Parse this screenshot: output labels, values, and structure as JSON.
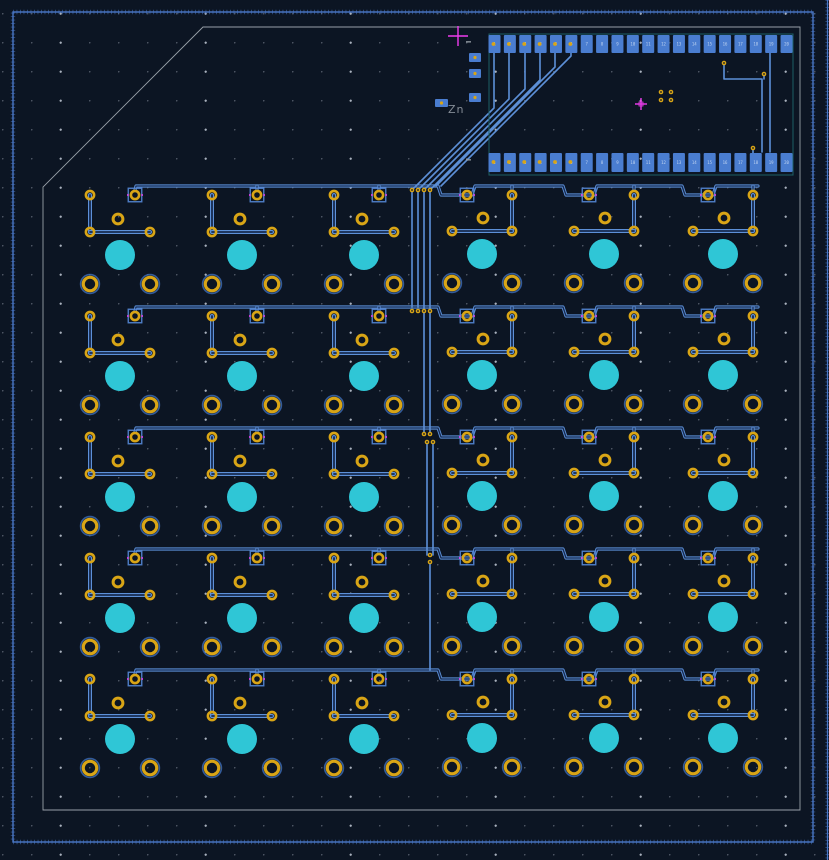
{
  "canvas": {
    "width": 829,
    "height": 860,
    "background": "#0c1523"
  },
  "colors": {
    "background": "#0c1523",
    "grid_dot": "#969eaf",
    "track": "#5d90d8",
    "track_inner": "#16294e",
    "pad_smd": "#4a7dd0",
    "pad_square_outline": "#5588d8",
    "pad_text": "#d8e6f8",
    "tht_ring_gold": "#d9a516",
    "hole_dark": "#0c1523",
    "npth_cyan": "#2fc6d6",
    "via_gold": "#d9a516",
    "courtyard_teal": "#1d6066",
    "board_edge_gray": "#98a0a8",
    "zone_outline_blue": "#4a78c8",
    "anchor_magenta": "#ee3cee",
    "ref_text_gray": "#858c96",
    "mount_halo_blue": "#3d6db8"
  },
  "zone": {
    "rect": [
      13,
      12,
      800,
      830
    ],
    "right_edge_x": 827.5
  },
  "board_edge": {
    "points": [
      [
        203,
        27
      ],
      [
        800,
        27
      ],
      [
        800,
        810
      ],
      [
        43,
        810
      ],
      [
        43,
        187
      ]
    ]
  },
  "origin_marker": {
    "x": 458,
    "y": 36,
    "arm": 10
  },
  "module": {
    "ref_label": "Zn",
    "ref_pos": [
      448,
      103
    ],
    "courtyard": [
      489,
      34,
      304,
      141
    ],
    "pad_count_per_row": 20,
    "first_pad_cx": 494.5,
    "pad_pitch": 15.37,
    "pad_w": 12,
    "top_pad_y": 35,
    "top_pad_h": 18,
    "bottom_pad_y": 153,
    "bottom_pad_h": 19,
    "pad_via_indices": [
      0,
      1,
      2,
      3,
      4,
      5
    ],
    "anchor_cross": [
      641,
      104
    ],
    "center_vias": [
      [
        661,
        92
      ],
      [
        671,
        92
      ],
      [
        661,
        100
      ],
      [
        671,
        100
      ]
    ],
    "extra_vias": [
      [
        724,
        63
      ],
      [
        753,
        148
      ],
      [
        764,
        74
      ]
    ],
    "side_pads": [
      [
        435,
        99,
        13,
        8
      ],
      [
        469,
        53,
        12,
        9
      ],
      [
        469,
        69,
        12,
        9
      ],
      [
        469,
        93,
        12,
        9
      ]
    ],
    "silk_dashes": [
      [
        466,
        41
      ],
      [
        466,
        159
      ]
    ],
    "right_traces": [
      [
        [
          724,
          63
        ],
        [
          724,
          79
        ],
        [
          762,
          79
        ],
        [
          762,
          152
        ]
      ],
      [
        [
          770,
          53
        ],
        [
          770,
          152
        ]
      ],
      [
        [
          753,
          148
        ],
        [
          753,
          157
        ]
      ],
      [
        [
          764,
          74
        ],
        [
          764,
          79
        ]
      ]
    ]
  },
  "fan_traces": [
    [
      [
        494,
        53
      ],
      [
        494,
        108
      ],
      [
        412,
        190
      ]
    ],
    [
      [
        509,
        53
      ],
      [
        509,
        99
      ],
      [
        418,
        190
      ]
    ],
    [
      [
        525,
        53
      ],
      [
        525,
        89
      ],
      [
        424,
        190
      ]
    ],
    [
      [
        540,
        53
      ],
      [
        540,
        80
      ],
      [
        430,
        190
      ]
    ],
    [
      [
        555,
        53
      ],
      [
        555,
        67
      ],
      [
        436,
        186
      ]
    ],
    [
      [
        571,
        53
      ],
      [
        571,
        56
      ],
      [
        441,
        186
      ]
    ]
  ],
  "column_traces": [
    {
      "x": 412,
      "y1": 190,
      "y2": 307
    },
    {
      "x": 418,
      "y1": 190,
      "y2": 307
    },
    {
      "x": 424,
      "y1": 190,
      "y2": 434
    },
    {
      "x": 430,
      "y1": 190,
      "y2": 434
    },
    {
      "x": 427,
      "y1": 442,
      "y2": 555
    },
    {
      "x": 433,
      "y1": 442,
      "y2": 555
    },
    {
      "x": 430,
      "y1": 562,
      "y2": 670
    }
  ],
  "vias": [
    [
      412,
      190
    ],
    [
      418,
      190
    ],
    [
      424,
      190
    ],
    [
      430,
      190
    ],
    [
      412,
      311
    ],
    [
      418,
      311
    ],
    [
      424,
      311
    ],
    [
      430,
      311
    ],
    [
      424,
      434
    ],
    [
      430,
      434
    ],
    [
      427,
      442
    ],
    [
      433,
      442
    ],
    [
      430,
      555
    ],
    [
      430,
      562
    ]
  ],
  "key_grid": {
    "row_y": [
      195,
      316,
      437,
      558,
      679
    ],
    "left_cols_x": [
      90,
      212,
      334
    ],
    "right_cols_x": [
      467,
      589,
      708
    ],
    "left_unit": {
      "plain_ring": [
        0,
        0
      ],
      "square_pad": [
        45,
        0
      ],
      "center_ring": [
        28,
        24
      ],
      "diode_rings": [
        [
          0,
          37
        ],
        [
          60,
          37
        ]
      ],
      "npth": [
        30,
        60
      ],
      "mount_holes": [
        [
          0,
          89
        ],
        [
          60,
          89
        ]
      ],
      "v_trace": [
        [
          0,
          0
        ],
        [
          0,
          37
        ]
      ],
      "h_trace": [
        [
          0,
          37
        ],
        [
          60,
          37
        ]
      ]
    },
    "right_unit": {
      "square_pad": [
        0,
        0
      ],
      "plain_ring": [
        45,
        0
      ],
      "center_ring": [
        16,
        23
      ],
      "diode_rings": [
        [
          -15,
          36
        ],
        [
          45,
          36
        ]
      ],
      "npth": [
        15,
        59
      ],
      "mount_holes": [
        [
          -15,
          88
        ],
        [
          45,
          88
        ]
      ],
      "v_trace": [
        [
          45,
          0
        ],
        [
          45,
          36
        ]
      ],
      "h_trace": [
        [
          -15,
          36
        ],
        [
          45,
          36
        ]
      ]
    },
    "ring_outer_r": 5.4,
    "ring_hole_r": 2.8,
    "center_ring_outer_r": 6.4,
    "center_ring_hole_r": 3.4,
    "mount_outer_r": 8.3,
    "mount_hole_r": 5.2,
    "npth_r": 15,
    "square_size": 13.5,
    "bus_dy": -9,
    "bus_x_start": 135,
    "bus_x_end": 758,
    "bus_stub_x": [
      257,
      379,
      512,
      634,
      753
    ]
  }
}
